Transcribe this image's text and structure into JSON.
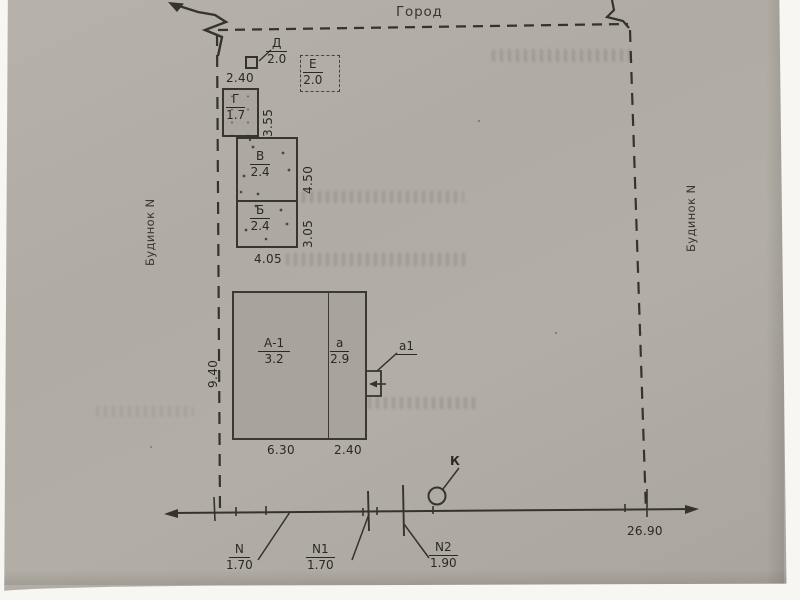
{
  "labels": {
    "street": "Город",
    "neighbor_left": "Будинок N",
    "neighbor_right": "Будинок N"
  },
  "structures": {
    "d": {
      "letter": "Д",
      "value": "2.0"
    },
    "e": {
      "letter": "Е",
      "value": "2.0"
    },
    "g": {
      "letter": "Г",
      "value": "1.7"
    },
    "v": {
      "letter": "В",
      "value": "2.4"
    },
    "b": {
      "letter": "Б",
      "value": "2.4"
    },
    "main": {
      "letter": "А-1",
      "value": "3.2"
    },
    "annex": {
      "letter": "а",
      "value": "2.9"
    },
    "porch": {
      "label": "а1"
    },
    "well": {
      "label": "К"
    }
  },
  "dimensions": {
    "g_width": "2.40",
    "g_depth": "3.55",
    "v_depth": "4.50",
    "b_depth": "3.05",
    "vb_width": "4.05",
    "main_depth": "9.40",
    "main_width": "6.30",
    "annex_width": "2.40",
    "frontage_total": "26.90"
  },
  "frontage_marks": {
    "n": {
      "name": "N",
      "width": "1.70"
    },
    "n1": {
      "name": "N1",
      "width": "1.70"
    },
    "n2": {
      "name": "N2",
      "width": "1.90"
    }
  },
  "colors": {
    "paper": "#b0aca4",
    "ink": "#2b2922"
  }
}
